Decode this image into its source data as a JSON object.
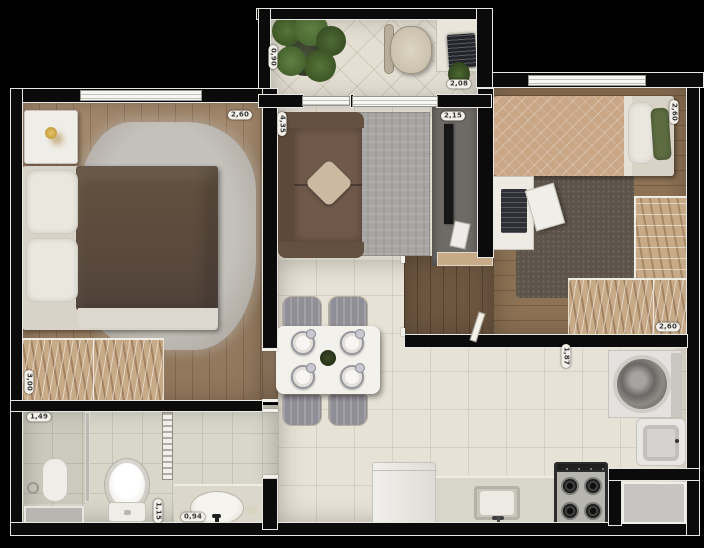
{
  "measurements": {
    "bedroom1_width": "2,60",
    "balcony_depth": "0,90",
    "living_length": "4,35",
    "home_office_width": "2,08",
    "living_width": "2,15",
    "bedroom2_length": "2,60",
    "bedroom1_length": "3,00",
    "bathroom_width": "1,49",
    "toilet_area_width": "1,15",
    "vanity_width": "0,94",
    "kitchen_width": "1,87",
    "bedroom2_wardrobe_width": "2,60"
  },
  "colors": {
    "background": "#000000",
    "wall": "#0b0b0b",
    "wall-trim": "#e9e7e1",
    "wood-bedroom1": "#a08365",
    "wood-bedroom2": "#8d7254",
    "wood-dark": "#6e5741",
    "tile-light": "#e7e2d6",
    "tile-bath": "#d8d7ca",
    "beige-furniture": "#c7ab89",
    "duvet-brown": "#5b4a3d",
    "sofa-brown": "#71594a",
    "quilt-tan": "#c9a686",
    "rug-living": "#a7a6a2",
    "rug-dark": "#5d544a",
    "plant-green": "#4f6b35",
    "pillow-green": "#5c6b40",
    "label-bg": "#f2f0e9",
    "label-text": "#373737"
  }
}
